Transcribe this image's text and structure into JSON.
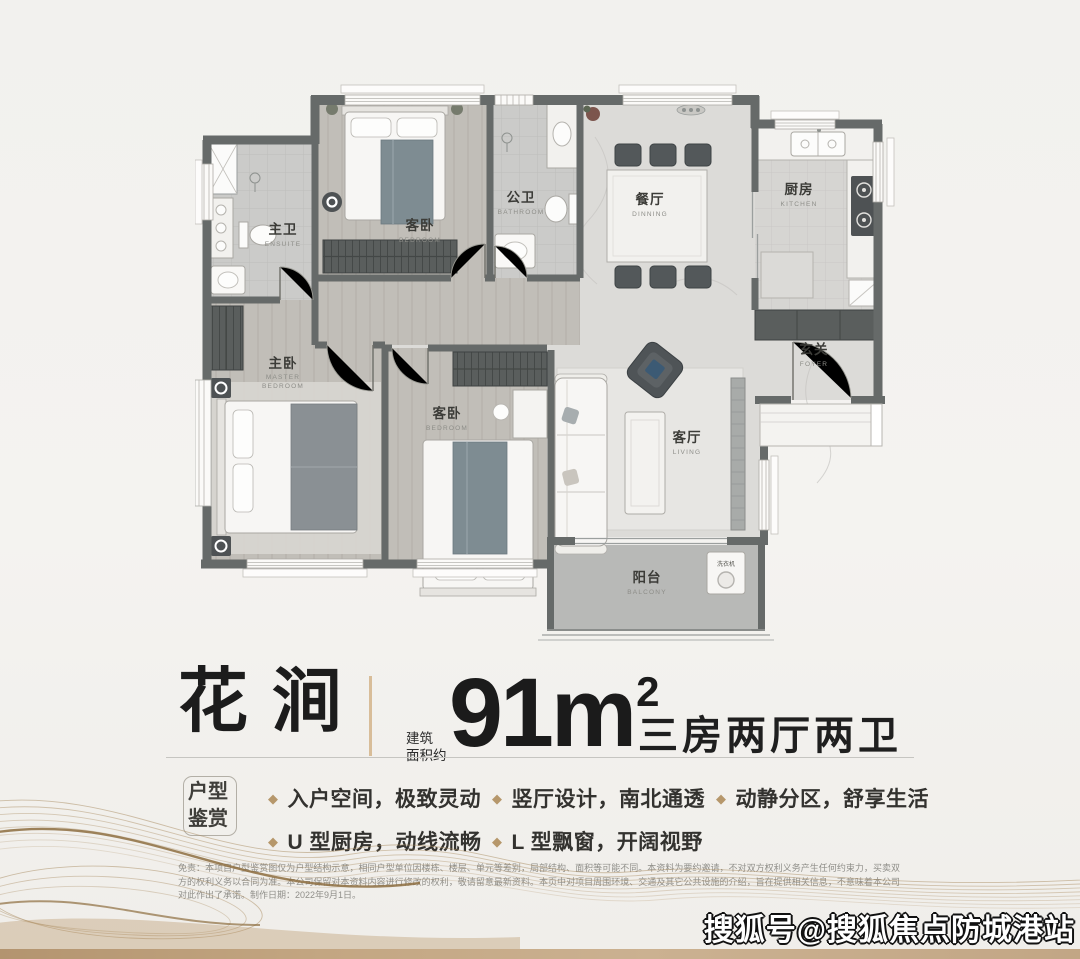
{
  "title": {
    "name": "花涧",
    "area_prefix_line1": "建筑",
    "area_prefix_line2": "面积约",
    "area_number": "91m",
    "area_sup": "2",
    "layout_desc": "三房两厅两卫"
  },
  "features": {
    "badge_line1": "户型",
    "badge_line2": "鉴赏",
    "items": [
      "入户空间，极致灵动",
      "U 型厨房，动线流畅",
      "竖厅设计，南北通透",
      "L 型飘窗，开阔视野",
      "动静分区，舒享生活"
    ]
  },
  "floor_plan": {
    "rooms": [
      {
        "zh": "主卫",
        "en": "ENSUITE"
      },
      {
        "zh": "客卧",
        "en": "BEDROOM"
      },
      {
        "zh": "公卫",
        "en": "BATHROOM"
      },
      {
        "zh": "餐厅",
        "en": "DINNING"
      },
      {
        "zh": "厨房",
        "en": "KITCHEN"
      },
      {
        "zh": "玄关",
        "en": "FOYER"
      },
      {
        "zh": "主卧",
        "en_line1": "MASTER",
        "en_line2": "BEDROOM"
      },
      {
        "zh": "客卧",
        "en": "BEDROOM"
      },
      {
        "zh": "客厅",
        "en": "LIVING"
      },
      {
        "zh": "阳台",
        "en": "BALCONY"
      }
    ],
    "appliances": {
      "washer": "洗衣机"
    }
  },
  "disclaimer": "免责：本项目户型鉴赏图仅为户型结构示意，相同户型单位因楼栋、楼层、单元等差别，局部结构、面积等可能不同。本资料为要约邀请，不对双方权利义务产生任何约束力，买卖双方的权利义务以合同为准。本公司保留对本资料内容进行修改的权利，敬请留意最新资料。本页中对项目周围环境、交通及其它公共设施的介绍，旨在提供相关信息，不意味着本公司对此作出了承诺。制作日期：2022年9月1日。",
  "watermark": "搜狐号@搜狐焦点防城港站",
  "colors": {
    "accent_gold": "#d8bd99",
    "bullet_gold": "#b6976b",
    "wall": "#666a69",
    "wood_floor": "#c1beb8",
    "marble_floor": "#dcdbd8",
    "blanket_teal": "#7e8c92",
    "bottom_band": "#c3a682"
  }
}
